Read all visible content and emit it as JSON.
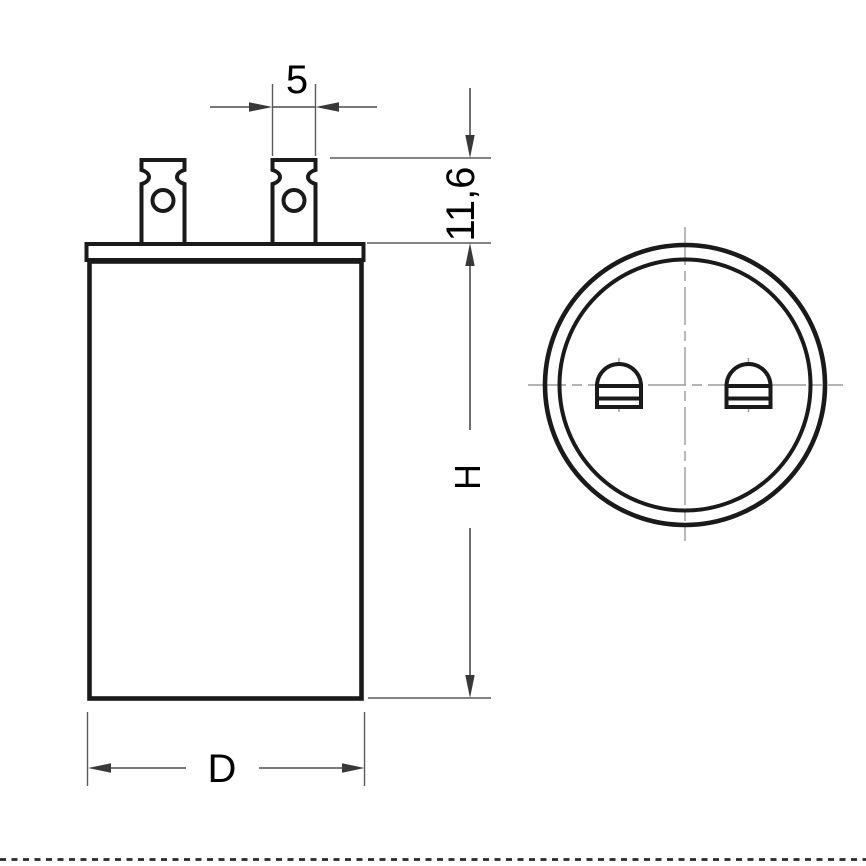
{
  "drawing": {
    "labels": {
      "terminal_width": "5",
      "terminal_height": "11,6",
      "body_height": "H",
      "body_diameter": "D"
    },
    "colors": {
      "object_line": "#1a1a1a",
      "dimension_line": "#4c4c4c",
      "arrow": "#383838",
      "centerline": "#9b9b9b",
      "label_text": "#000000",
      "background": "#ffffff",
      "bottom_border_dash": "#2a2a2a"
    }
  }
}
